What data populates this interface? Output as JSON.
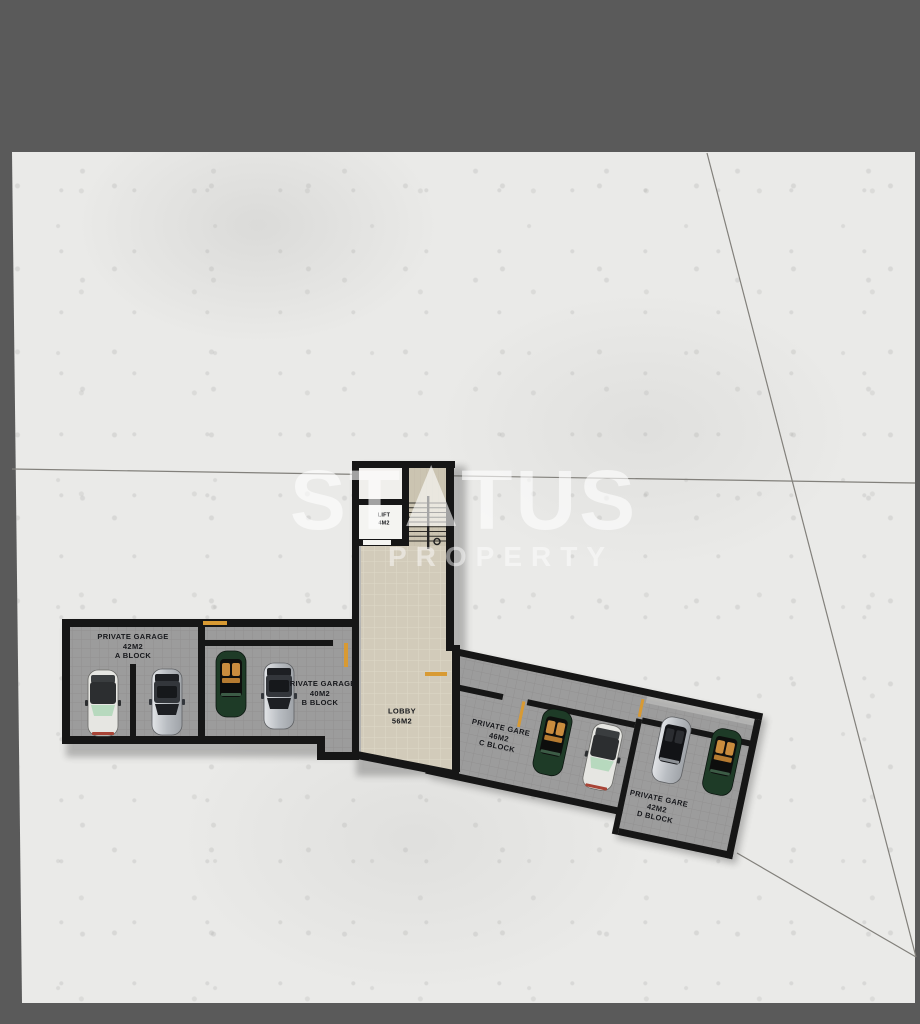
{
  "watermark": {
    "brand_prefix": "ST",
    "brand_suffix": "TUS",
    "subtitle": "PROPERTY"
  },
  "rooms": {
    "lift": {
      "lines": [
        "LIFT",
        "4M2"
      ]
    },
    "lobby": {
      "lines": [
        "LOBBY",
        "56M2"
      ]
    },
    "garage_a": {
      "lines": [
        "PRIVATE GARAGE",
        "42M2",
        "A BLOCK"
      ]
    },
    "garage_b": {
      "lines": [
        "PRIVATE GARAGE",
        "40M2",
        "B BLOCK"
      ]
    },
    "garage_c": {
      "lines": [
        "PRIVATE GARE",
        "46M2",
        "C BLOCK"
      ]
    },
    "garage_d": {
      "lines": [
        "PRIVATE GARE",
        "42M2",
        "D BLOCK"
      ]
    }
  },
  "cars": [
    {
      "block": "A",
      "type": "sedan",
      "color": "white"
    },
    {
      "block": "A",
      "type": "sedan",
      "color": "silver"
    },
    {
      "block": "B",
      "type": "convertible",
      "color": "green"
    },
    {
      "block": "B",
      "type": "sedan",
      "color": "silver"
    },
    {
      "block": "C",
      "type": "convertible",
      "color": "green"
    },
    {
      "block": "C",
      "type": "sedan",
      "color": "white"
    },
    {
      "block": "D",
      "type": "convertible",
      "color": "silver"
    },
    {
      "block": "D",
      "type": "convertible",
      "color": "green"
    }
  ],
  "colors": {
    "background": "#5a5a5a",
    "concrete": "#eaeae8",
    "wall": "#161616",
    "garage_floor": "#9c9c9c",
    "lobby_floor": "#d2cbba",
    "stairs_floor": "#cbc4b1",
    "lift_floor": "#f4f4f1",
    "door_marker": "#d89a33",
    "watermark": "#ffffff",
    "label_text": "#17181c"
  }
}
